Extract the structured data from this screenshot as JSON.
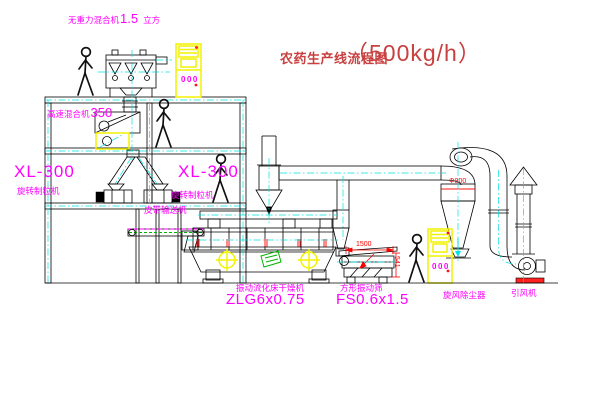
{
  "title": {
    "text": "农药生产线流程图",
    "capacity": "（500kg/h）"
  },
  "labels": {
    "zero_gravity_mixer": {
      "name": "无重力混合机",
      "size": "1.5",
      "unit": "立方"
    },
    "high_speed_mixer": {
      "name": "高速混合机",
      "size": "350"
    },
    "granulator_left": {
      "model": "XL-300",
      "name": "旋转制粒机"
    },
    "granulator_right": {
      "model": "XL-300",
      "name": "旋转制粒机"
    },
    "belt_conveyor": "皮带输送机",
    "dryer": {
      "name": "振动流化床干燥机",
      "model": "ZLG6x0.75"
    },
    "sieve": {
      "name": "方形振动筛",
      "model": "FS0.6x1.5"
    },
    "cyclone": "旋风除尘器",
    "fan": "引风机"
  },
  "dimensions": {
    "cyclone_diameter": "Φ800",
    "sieve_length": "1500",
    "sieve_height": "541"
  },
  "cabinets": {
    "top_display": "000",
    "bottom_display": "000"
  },
  "colors": {
    "label_magenta": "#ff00ff",
    "title_red": "#c94040",
    "dimension_red": "#ff0000",
    "highlight_yellow": "#f2f200",
    "centerline_cyan": "#00dfdf",
    "accent_green": "#00b300"
  }
}
